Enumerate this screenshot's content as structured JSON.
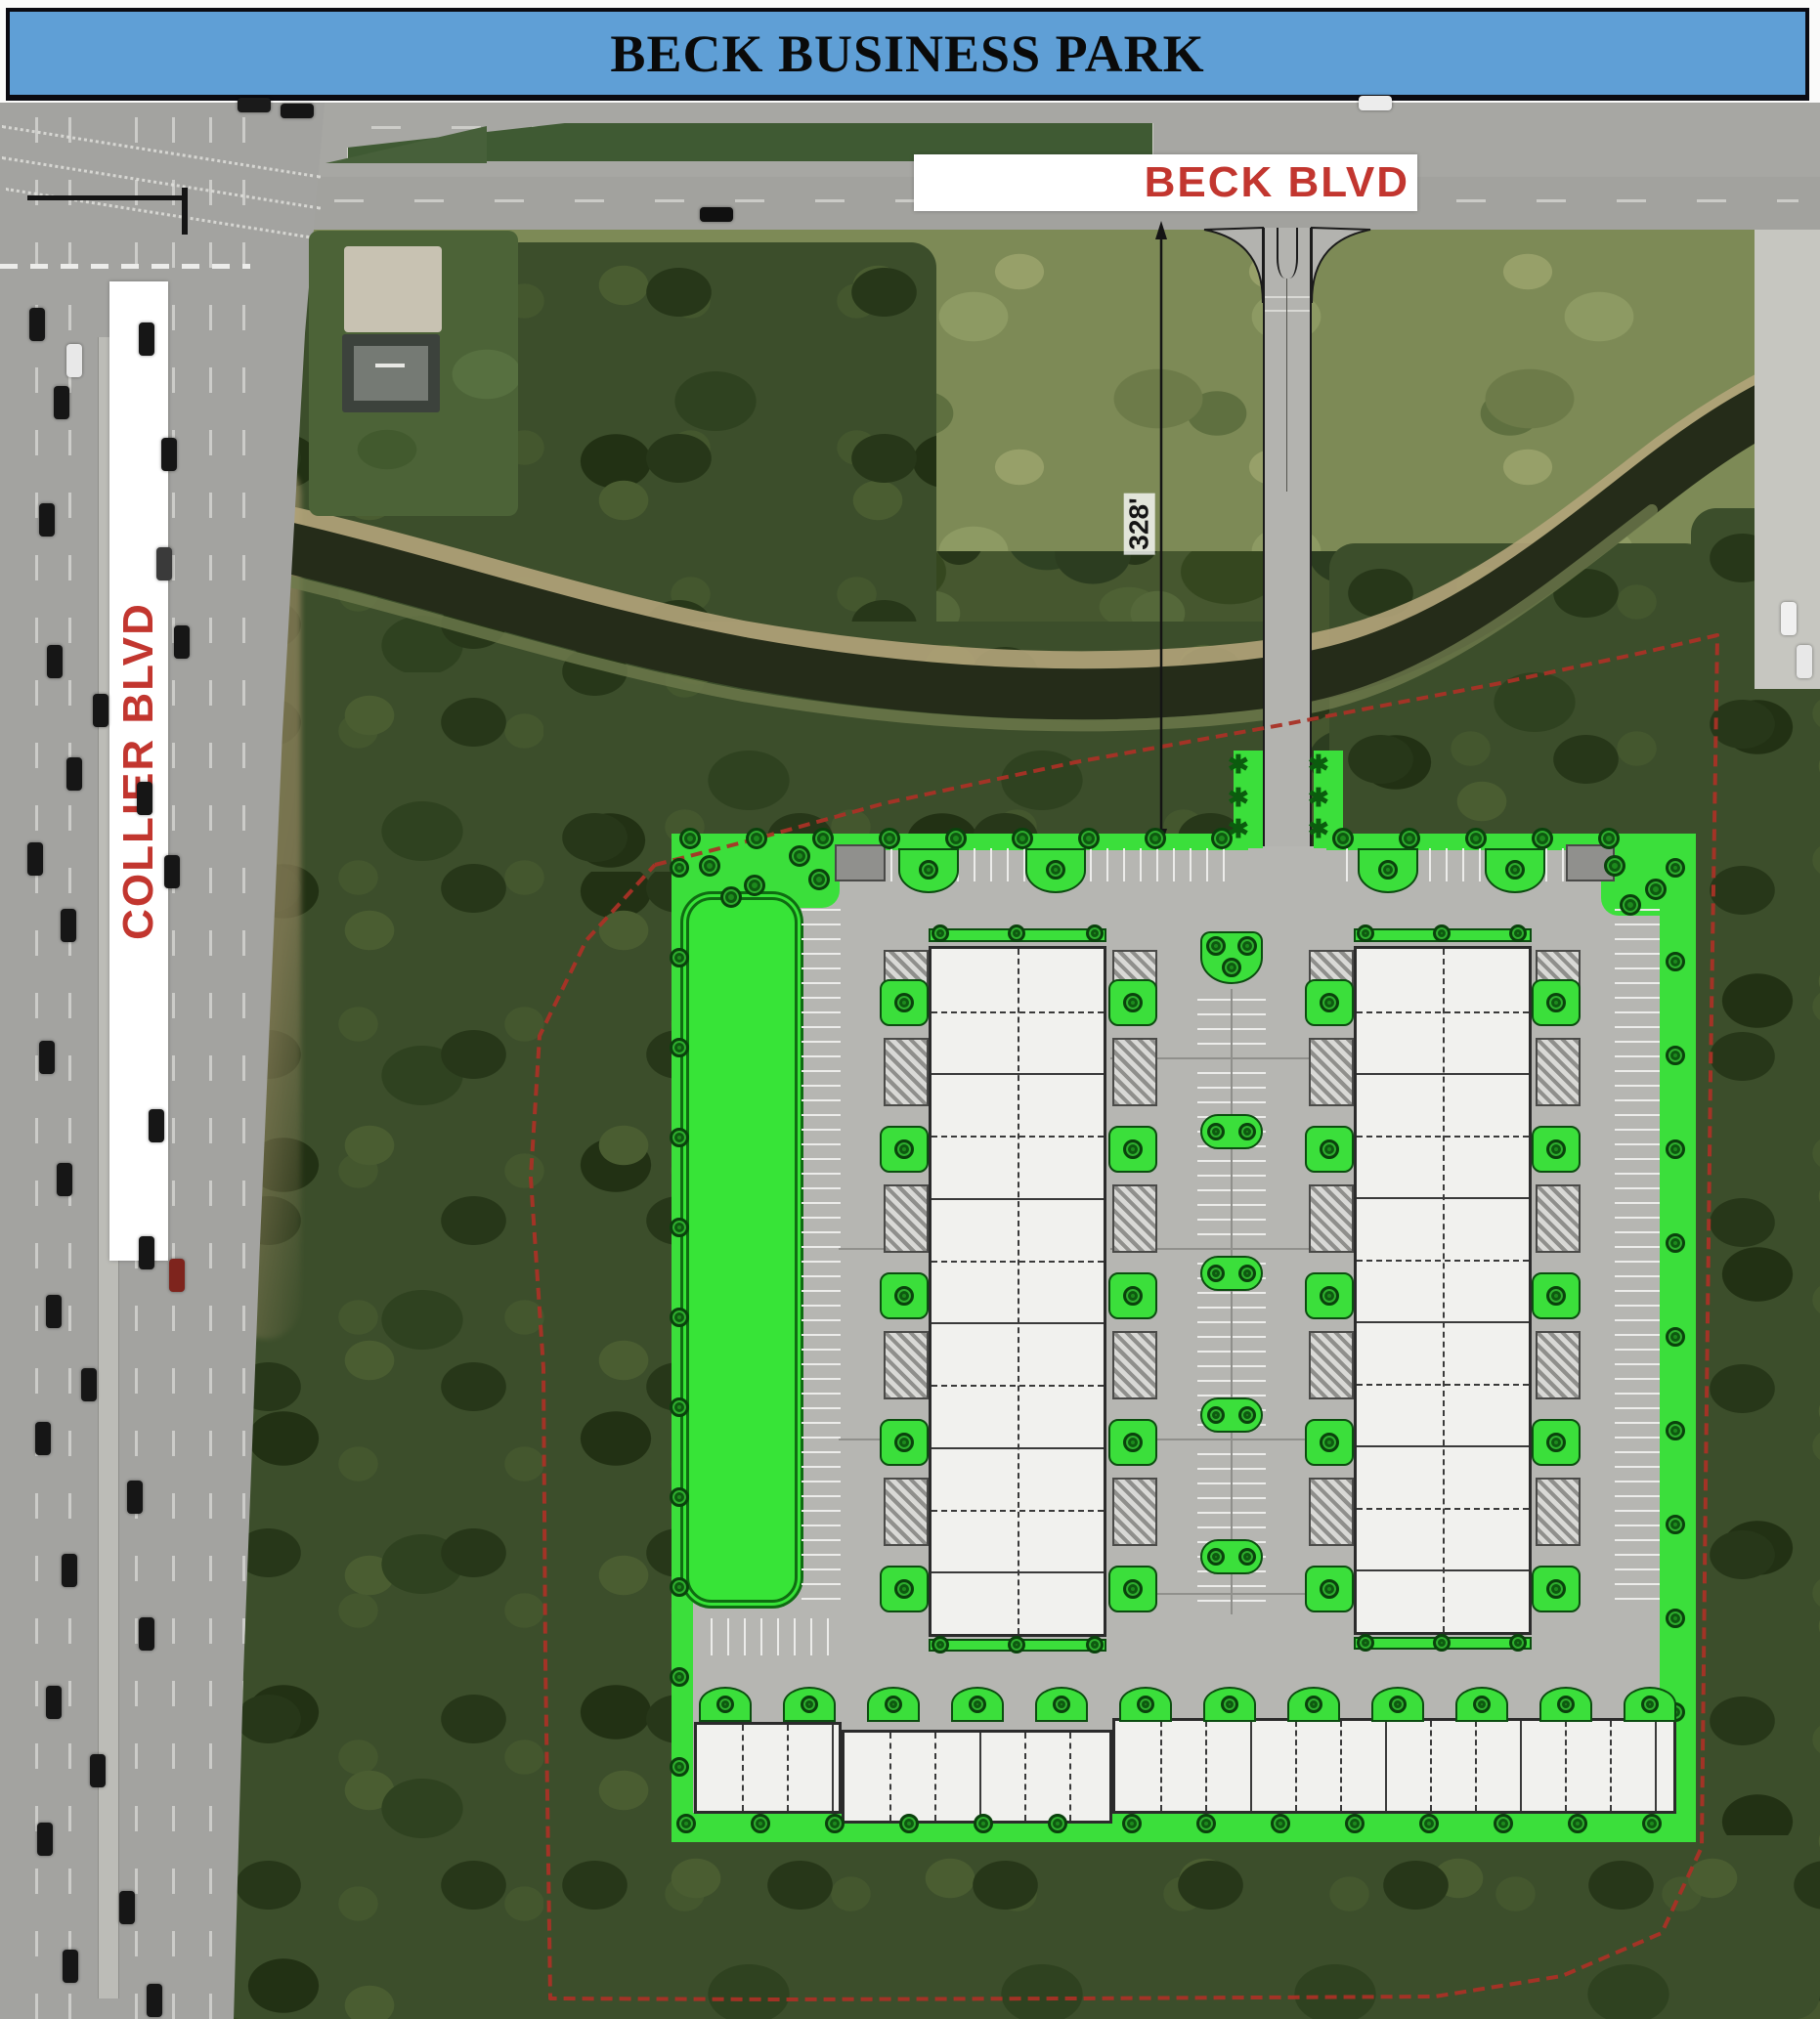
{
  "banner": {
    "title": "BECK BUSINESS PARK",
    "bg_color": "#5f9fd6",
    "border_color": "#0b0b12"
  },
  "labels": {
    "beck_blvd": "BECK BLVD",
    "collier_blvd": "COLLIER BLVD",
    "dimension": "328'",
    "road_label_color": "#c2362f",
    "road_label_bg": "#ffffff"
  },
  "site_plan": {
    "boundary_color": "#a93226",
    "landscape_green": "#3bdf3b",
    "pond_green": "#37e437",
    "tree_green": "#1d8a1d",
    "paving_gray": "#b6b6b2",
    "building_fill": "#f1f1ee",
    "building_border": "#2b2b2b",
    "buildings": [
      "warehouse-1",
      "warehouse-2",
      "flex-strip-building"
    ]
  },
  "aerial": {
    "forest_green": "#3c4e2b",
    "grass_olive": "#7d8a56",
    "road_gray": "#a7a7a3",
    "canal_dark": "#252c19",
    "canal_bank_tan": "#b3a47a"
  }
}
